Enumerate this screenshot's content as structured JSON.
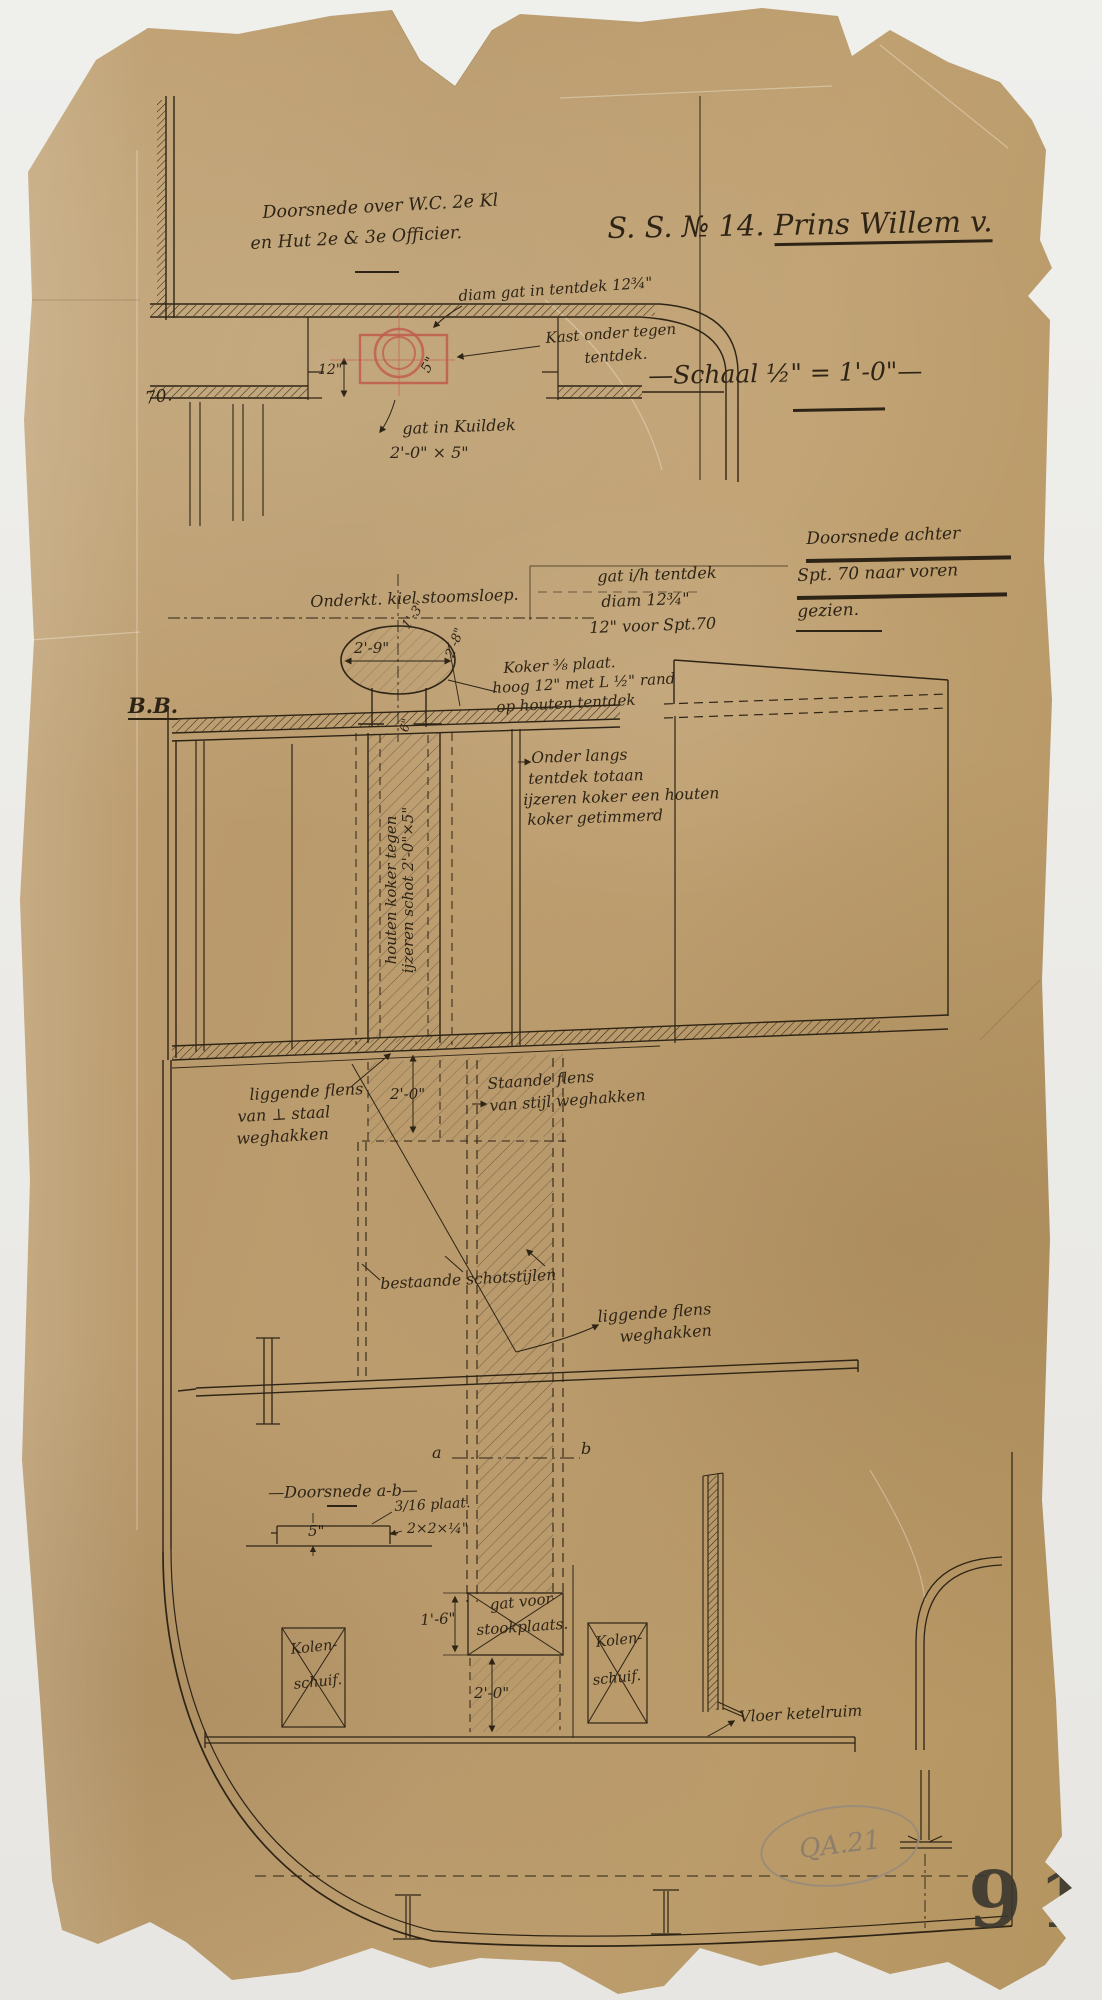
{
  "document": {
    "title_prefix": "S. S. № 14.",
    "title_name": "Prins Willem v.",
    "scale_line": "—Schaal ½\" = 1'-0\"—",
    "stamp_number": "91",
    "archive_mark": "QA.21"
  },
  "detail_top_left": {
    "caption_line1": "Doorsnede over W.C. 2e Kl",
    "caption_line2": "en Hut 2e & 3e Officier.",
    "note_diam": "diam gat in tentdek 12¾\"",
    "note_kast_line1": "Kast onder tegen",
    "note_kast_line2": "tentdek.",
    "dim_12": "12\"",
    "dim_5": "5\"",
    "note_gat_kuildek_line1": "gat in Kuildek",
    "note_gat_kuildek_line2": "2'-0\" × 5\"",
    "frame_number": "70."
  },
  "main_section": {
    "view_caption_line1": "Doorsnede achter",
    "view_caption_line2": "Spt. 70 naar voren",
    "view_caption_line3": "gezien.",
    "section_mark": "B.B.",
    "note_onderkant": "Onderkt. kiel stoomsloep.",
    "note_gat_line1": "gat i/h tentdek",
    "note_gat_line2": "diam 12¾\"",
    "note_gat_line3": "12\" voor Spt.70",
    "dim_2_9": "2'-9\"",
    "dim_1_3": "1'-3\"",
    "dim_2_8": "2'-8\"",
    "note_koker_line1": "Koker ⅜ plaat.",
    "note_koker_line2": "hoog 12\" met L ½\" rand",
    "note_koker_line3": "op houten tentdek",
    "note_houten_line1": "Onder langs",
    "note_houten_line2": "tentdek totaan",
    "note_houten_line3": "ijzeren koker een houten",
    "note_houten_line4": "koker getimmerd",
    "note_vert_line1": "houten koker tegen",
    "note_vert_line2": "ijzeren schot 2'-0\"×5\"",
    "dim_6": "6\"",
    "note_ligg1_line1": "liggende flens",
    "note_ligg1_line2": "van ⊥ staal",
    "note_ligg1_line3": "weghakken",
    "dim_2_0_tween": "2'-0\"",
    "note_staande_line1": "Staande flens",
    "note_staande_line2": "van stijl  weghakken",
    "note_bestaande": "bestaande schotstijlen",
    "note_ligg2_line1": "liggende flens",
    "note_ligg2_line2": "weghakken",
    "label_a": "a",
    "label_b": "b",
    "detail_ab_caption": "—Doorsnede a-b—",
    "note_plaat": "3/16 plaat.",
    "note_angle": "2×2×¼\"",
    "dim_5_ab": "5\"",
    "dim_1_6": "1'-6\"",
    "note_stook_line1": "gat voor",
    "note_stook_line2": "stookplaats.",
    "dim_2_0_stook": "2'-0\"",
    "kolen_left_line1": "Kolen-",
    "kolen_left_line2": "schuif.",
    "kolen_right_line1": "Kolen-",
    "kolen_right_line2": "schuif.",
    "note_vloer": "Vloer ketelruim"
  },
  "colors": {
    "paper": "#bb9c6d",
    "ink": "#2e2416",
    "red_pencil": "#c05a4b",
    "pencil": "#8d7f6c",
    "background": "#ebebe8"
  }
}
